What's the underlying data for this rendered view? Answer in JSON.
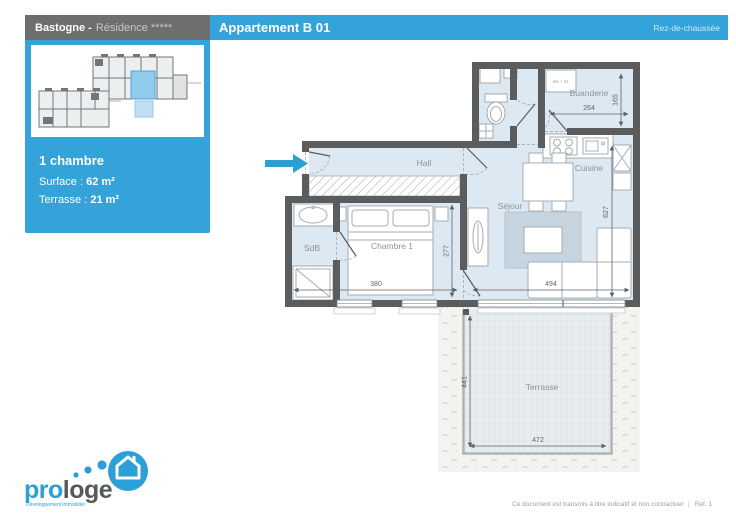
{
  "header": {
    "project_bold": "Bastogne -",
    "project_light": "Résidence *****",
    "title": "Appartement B 01",
    "floor": "Rez-de-chaussée"
  },
  "sidebar": {
    "room_count": "1 chambre",
    "surface_label": "Surface :",
    "surface_value": "62 m²",
    "terrace_label": "Terrasse :",
    "terrace_value": "21 m²"
  },
  "plan": {
    "rooms": {
      "hall": "Hall",
      "sejour": "Séjour",
      "cuisine": "Cuisine",
      "buanderie": "Buanderie",
      "sdb": "SdB",
      "chambre": "Chambre 1",
      "terrasse": "Terrasse",
      "appliances": "ML + SL"
    },
    "dims": {
      "buanderie_w": "264",
      "buanderie_h": "165",
      "sejour_h": "627",
      "chambre_w": "380",
      "chambre_h": "277",
      "sejour_w": "494",
      "terrasse_h": "441",
      "terrasse_w": "472"
    }
  },
  "logo": {
    "brand_pro": "pro",
    "brand_loge": "loge",
    "tagline": "Développement immobilier"
  },
  "footer": {
    "disclaimer": "Ce document est transmis à titre indicatif et non contractuel",
    "separator": "|",
    "reference": "Réf. 1"
  },
  "colors": {
    "accent_blue": "#34a3d9",
    "wall_gray": "#5b5c5e",
    "highlight_unit": "#8ecbec",
    "entrance_arrow": "#2e9fd4"
  }
}
